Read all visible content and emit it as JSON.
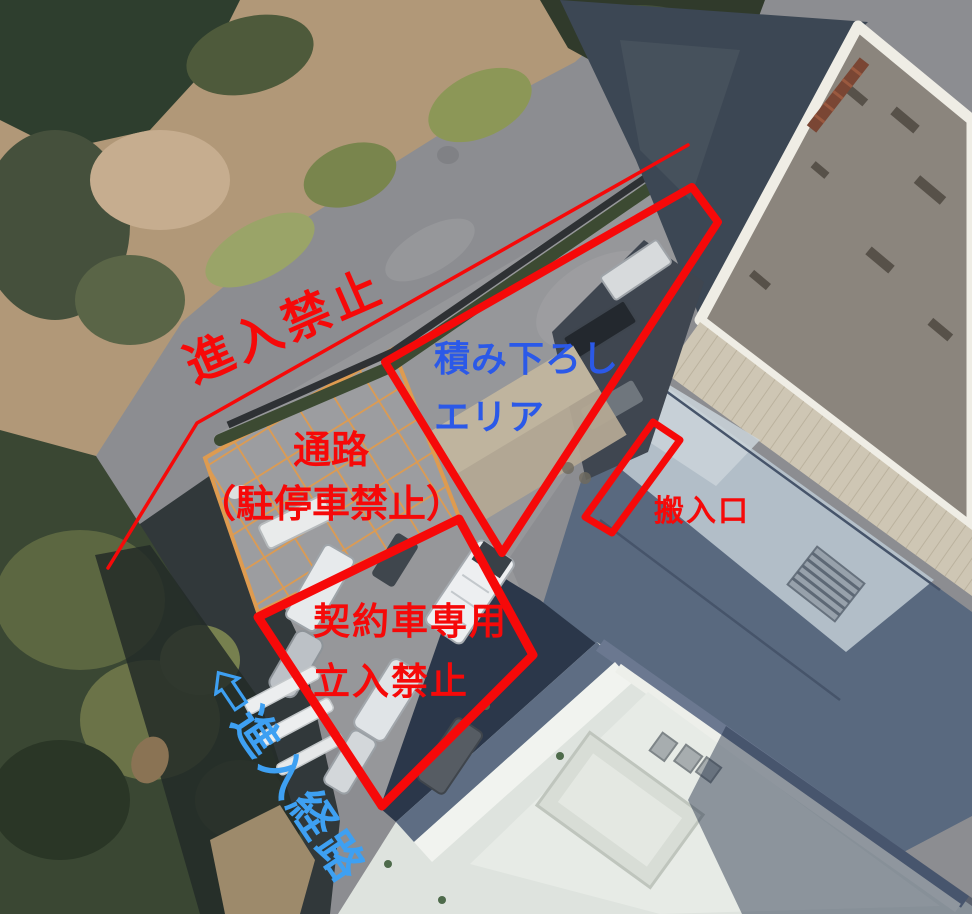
{
  "annotation_colors": {
    "red": "#f60909",
    "blue_dark": "#2b59e8",
    "blue_light": "#3ea0f2"
  },
  "annotations": {
    "labels": {
      "no_entry": "進入禁止",
      "loading_area_line1": "積み下ろし",
      "loading_area_line2": "エリア",
      "passage_line1": "通路",
      "passage_line2": "（駐停車禁止）",
      "entrance": "搬入口",
      "contract_line1": "契約車専用",
      "contract_line2": "立入禁止",
      "route": "⇦進入経路",
      "route_arrow_glyph": "⇦"
    },
    "shapes": {
      "no_entry_line": {
        "points": "688,145 197,423 108,568"
      },
      "loading_area_outline": {
        "points": "692,187 718,222 502,553 385,362"
      },
      "entrance_box": {
        "points": "653,422 680,440 612,533 585,517"
      },
      "contract_area_outline": {
        "points": "459,519 533,655 382,806 258,617"
      }
    }
  }
}
